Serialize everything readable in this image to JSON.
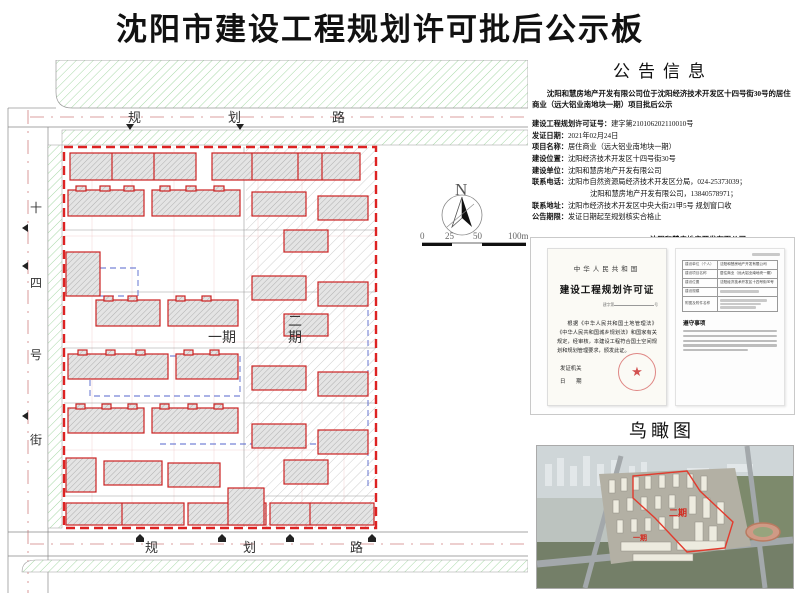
{
  "page_title": "沈阳市建设工程规划许可批后公示板",
  "colors": {
    "boundary_red": "#cc2222",
    "green_hatch": "#8fce8f",
    "blue_dash": "#5566cc",
    "seal_red": "#c82828"
  },
  "site_plan": {
    "road_top_chars": [
      "规",
      "划",
      "路"
    ],
    "road_left_chars": [
      "十",
      "四",
      "号",
      "街"
    ],
    "road_bottom_chars": [
      "规",
      "划",
      "路"
    ],
    "phase1_label": "一期",
    "phase2_chars": [
      "二",
      "期"
    ],
    "compass_n": "N",
    "scale_ticks": [
      "0",
      "25",
      "50",
      "100m"
    ]
  },
  "announcement": {
    "title": "公告信息",
    "intro": "沈阳和慧房地产开发有限公司位于沈阳经济技术开发区十四号街30号的居住商业（远大铝业南地块一期）项目批后公示",
    "fields": [
      {
        "label": "建设工程规划许可证号：",
        "value": "建字第210106202110010号"
      },
      {
        "label": "发证日期：",
        "value": "2021年02月24日"
      },
      {
        "label": "项目名称：",
        "value": "居住商业（远大铝业南地块一期）"
      },
      {
        "label": "建设位置：",
        "value": "沈阳经济技术开发区十四号街30号"
      },
      {
        "label": "建设单位：",
        "value": "沈阳和慧房地产开发有限公司"
      },
      {
        "label": "联系电话：",
        "value": "沈阳市自然资源局经济技术开发区分局，024-25373039；"
      },
      {
        "label": "联系地址：",
        "value": "沈阳市经济技术开发区中央大街21甲5号  规划窗口收"
      },
      {
        "label": "公告期限：",
        "value": "发证日期起至规划核实合格止"
      }
    ],
    "phone_line2": "沈阳和慧房地产开发有限公司，13840578971；",
    "sign_company": "沈阳和慧房地产开发有限公司",
    "sign_bureau": "沈阳市自然资源局经济技术开发区分局  监制",
    "sign_date": "2021年3月3日"
  },
  "certificate": {
    "left": {
      "country": "中华人民共和国",
      "title": "建设工程规划许可证",
      "no_prefix": "建字第",
      "no_suffix": "号",
      "body": "根据《中华人民共和国土地管理法》《中华人民共和国城乡规划法》和国家有关规定，经审核，本建设工程符合国土空间规划和规划管理要求，颁发此证。",
      "issuer_label": "发证机关",
      "date_label": "日　　期",
      "seal_star": "★"
    },
    "right": {
      "rows": [
        {
          "label": "建设单位（个人）",
          "value": "沈阳和慧房地产开发有限公司"
        },
        {
          "label": "建设项目名称",
          "value": "居住商业（远大铝业南地块一期）"
        },
        {
          "label": "建设位置",
          "value": "沈阳经济技术开发区十四号街30号"
        },
        {
          "label": "建设规模",
          "value": ""
        },
        {
          "label": "附图及附件名称",
          "value": ""
        }
      ],
      "notes_title": "遵守事项"
    }
  },
  "bird_view": {
    "title": "鸟瞰图",
    "phase2_label": "二期",
    "phase1_label": "一期"
  }
}
